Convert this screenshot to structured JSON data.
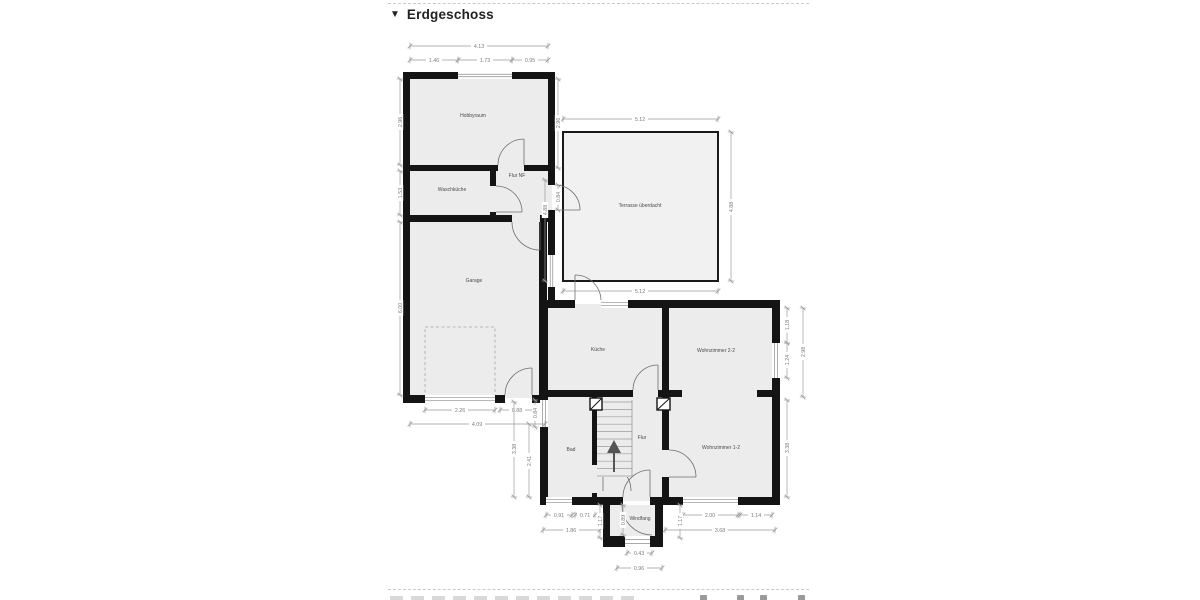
{
  "header": {
    "collapse_icon": "▼",
    "title": "Erdgeschoss"
  },
  "plan": {
    "rooms": {
      "hobbyraum": "Hobbyraum",
      "waschkueche": "Waschküche",
      "flur_nf": "Flur NF",
      "garage": "Garage",
      "terrasse": "Terrasse überdacht",
      "kueche": "Küche",
      "wohnzimmer22": "Wohnzimmer 2-2",
      "wohnzimmer12": "Wohnzimmer 1-2",
      "bad": "Bad",
      "flur": "Flur",
      "windfang": "Windfang"
    },
    "dims": {
      "top_total": "4.13",
      "top_left": "1.46",
      "top_mid": "1.73",
      "top_right": "0.95",
      "hobby_left": "2.96",
      "wasch_left": "1.53",
      "garage_left": "6.00",
      "hobby_right": "2.96",
      "flurnf_door": "0.84",
      "terrace_left": "4.88",
      "terrace_top": "5.12",
      "terrace_bottom": "5.12",
      "terrace_right": "4.88",
      "garage_door": "2.26",
      "garage_exit": "0.88",
      "garage_bottom": "4.09",
      "bad_window_h": "0.84",
      "bad_height": "3.38",
      "bad_inner": "2.41",
      "bad_window_w": "0.91",
      "bad_door_w": "0.71",
      "bad_bottom": "1.86",
      "wz22_upper": "1.18",
      "wz22_window": "1.24",
      "wz22_height": "2.98",
      "wz12_height": "3.38",
      "wz12_window": "2.00",
      "wz12_corner": "1.14",
      "wz12_bottom": "3.68",
      "windfang_left": "1.17",
      "windfang_inner": "0.89",
      "windfang_right": "1.17",
      "windfang_door": "0.43",
      "windfang_bottom": "0.96"
    },
    "colors": {
      "wall": "#141414",
      "room_fill": "#ececec",
      "terrace_fill": "#f1f1f1",
      "dim": "#9a9a9a"
    }
  }
}
